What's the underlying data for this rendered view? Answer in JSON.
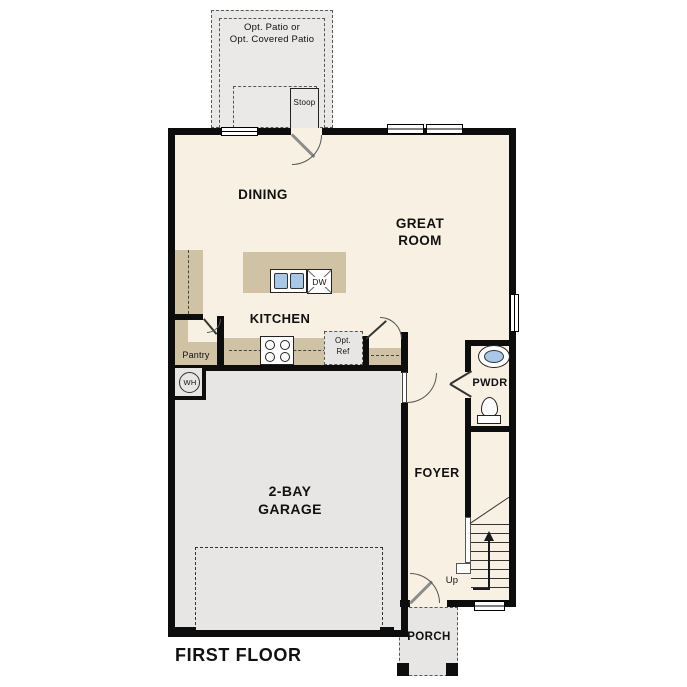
{
  "plan_title": "FIRST FLOOR",
  "labels": {
    "patio_line1": "Opt. Patio or",
    "patio_line2": "Opt. Covered Patio",
    "stoop": "Stoop",
    "dining": "DINING",
    "great_room_line1": "GREAT",
    "great_room_line2": "ROOM",
    "kitchen": "KITCHEN",
    "pantry": "Pantry",
    "dishwasher": "DW",
    "water_heater": "WH",
    "opt_ref_line1": "Opt.",
    "opt_ref_line2": "Ref",
    "powder_room": "PWDR",
    "foyer": "FOYER",
    "garage_line1": "2-BAY",
    "garage_line2": "GARAGE",
    "stairs_up": "Up",
    "porch": "PORCH"
  },
  "colors": {
    "interior_floor": "#f8f0e3",
    "counter_tan": "#cfc2a5",
    "garage_gray": "#e7e6e4",
    "patio_gray": "#ebe9e7",
    "sink_blue": "#a9c7e7",
    "wall_black": "#0d0d0d"
  }
}
